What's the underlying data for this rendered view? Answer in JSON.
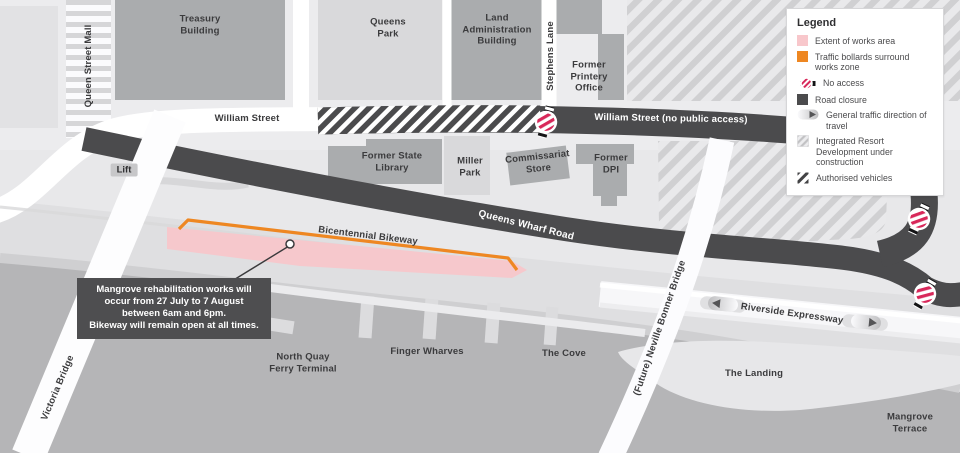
{
  "legend": {
    "title": "Legend",
    "items": [
      {
        "id": "works-area",
        "label": "Extent of works area",
        "color": "#f8c7cb"
      },
      {
        "id": "bollards",
        "label": "Traffic bollards surround works zone",
        "color": "#ee8722"
      },
      {
        "id": "no-access",
        "label": "No access",
        "color": "#d8285a"
      },
      {
        "id": "road-closure",
        "label": "Road closure",
        "color": "#4b4b4d"
      },
      {
        "id": "traffic-direction",
        "label": "General traffic direction of travel"
      },
      {
        "id": "ird",
        "label": "Integrated Resort Development under construction"
      },
      {
        "id": "authorised",
        "label": "Authorised vehicles"
      }
    ]
  },
  "callout": {
    "lines": [
      "Mangrove rehabilitation works will",
      "occur from 27 July to 7 August",
      "between 6am and 6pm.",
      "Bikeway will remain open at all times."
    ]
  },
  "map": {
    "labels": {
      "queen_street_mall": "Queen Street Mall",
      "treasury": "Treasury\nBuilding",
      "queens_park": "Queens\nPark",
      "land_admin": "Land\nAdministration\nBuilding",
      "stephens_lane": "Stephens Lane",
      "former_printery": "Former\nPrintery\nOffice",
      "william_street": "William Street",
      "william_street_closed": "William Street (no public access)",
      "state_library": "Former State\nLibrary",
      "miller_park": "Miller\nPark",
      "commissariat": "Commissariat\nStore",
      "former_dpi": "Former\nDPI",
      "lift": "Lift",
      "queens_wharf_road": "Queens Wharf Road",
      "bicentennial_bikeway": "Bicentennial Bikeway",
      "victoria_bridge": "Victoria Bridge",
      "north_quay": "North Quay\nFerry Terminal",
      "finger_wharves": "Finger Wharves",
      "the_cove": "The Cove",
      "neville_bonner": "(Future) Neville Bonner Bridge",
      "riverside_expressway": "Riverside Expressway",
      "the_landing": "The Landing",
      "mangrove_terrace": "Mangrove\nTerrace"
    },
    "colors": {
      "works_area": "#f8c7cb",
      "bollards": "#ee8722",
      "road_closure": "#4b4b4d",
      "no_access_red": "#d8285a",
      "river": "#b5b5b7"
    }
  }
}
